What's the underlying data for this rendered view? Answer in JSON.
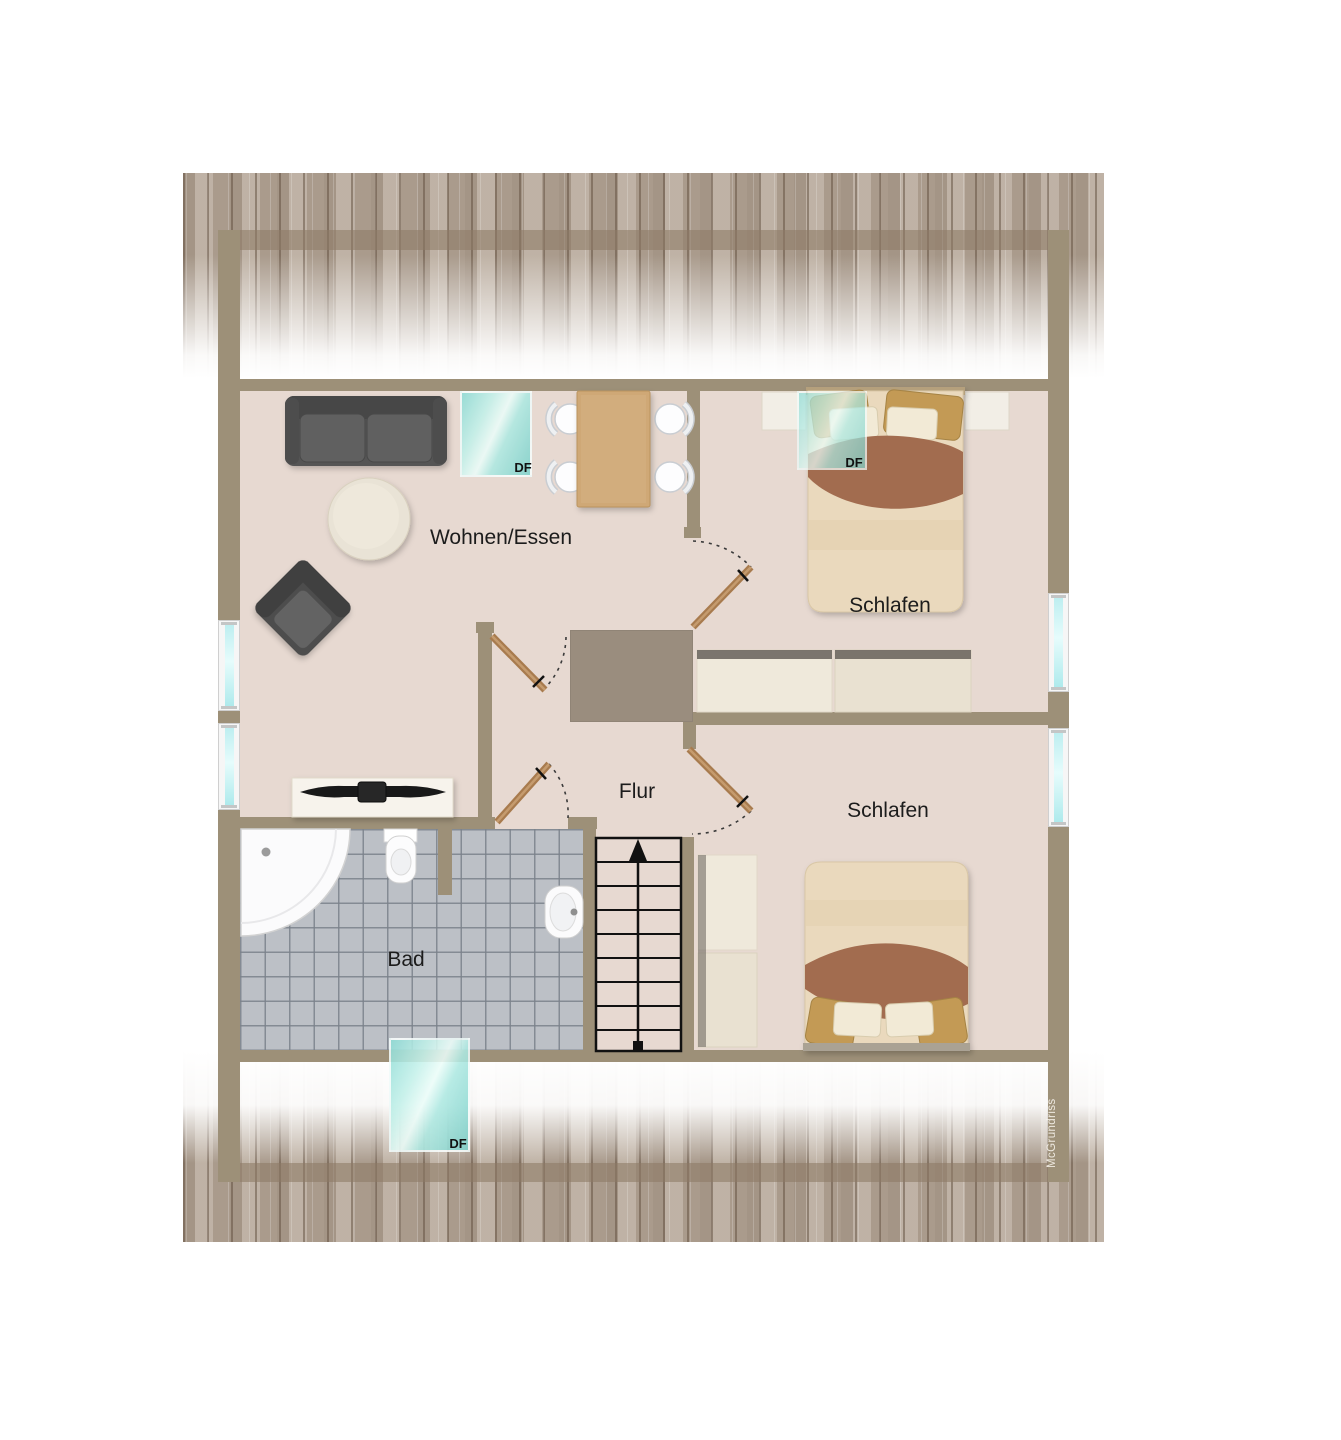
{
  "diagram": {
    "type": "attic-floor-plan",
    "watermark": "McGrundriss",
    "rooms": [
      {
        "id": "wohnen-essen",
        "label": "Wohnen/Essen"
      },
      {
        "id": "schlafen-1",
        "label": "Schlafen"
      },
      {
        "id": "schlafen-2",
        "label": "Schlafen"
      },
      {
        "id": "flur",
        "label": "Flur"
      },
      {
        "id": "bad",
        "label": "Bad"
      }
    ],
    "skylights": [
      {
        "id": "df-wohnen",
        "label": "DF"
      },
      {
        "id": "df-schlafen",
        "label": "DF"
      },
      {
        "id": "df-bad",
        "label": "DF"
      }
    ],
    "stairs": {
      "treads": 9,
      "direction": "up-arrow"
    },
    "furniture": [
      "sofa",
      "coffee-table",
      "armchair",
      "dining-table",
      "dining-chairs",
      "double-bed",
      "nightstands",
      "wardrobes",
      "sideboard-tv",
      "corner-shower",
      "toilet",
      "sink"
    ],
    "colors": {
      "wall": "#9d9078",
      "floor": "#e7d9d1",
      "tile": "#bcc0c6",
      "roof_texture": "#b2a496",
      "window_glass": "#bdeef0",
      "skylight": "#aee9e2",
      "door_leaf": "#aa7d4f",
      "sofa": "#575757",
      "bed_blanket": "#a26c50",
      "bed_sheet": "#ead9bd",
      "pillow_gold": "#c39a55",
      "table_wood": "#cfa876"
    }
  }
}
